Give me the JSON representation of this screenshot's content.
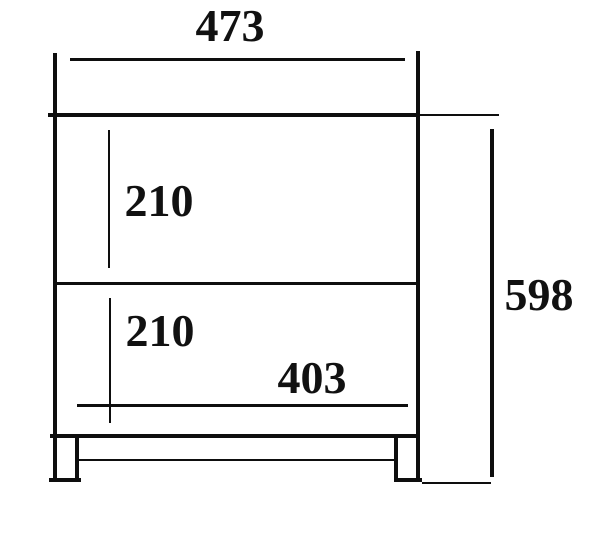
{
  "diagram": {
    "type": "dimensioned-technical-drawing",
    "subject": "front elevation of a two-drawer cabinet with legs",
    "line_color": "#0e0e0e",
    "background_color": "#ffffff",
    "dimensions": {
      "overall_width": "473",
      "top_drawer_height": "210",
      "bottom_drawer_height": "210",
      "inner_width": "403",
      "overall_height": "598"
    }
  }
}
